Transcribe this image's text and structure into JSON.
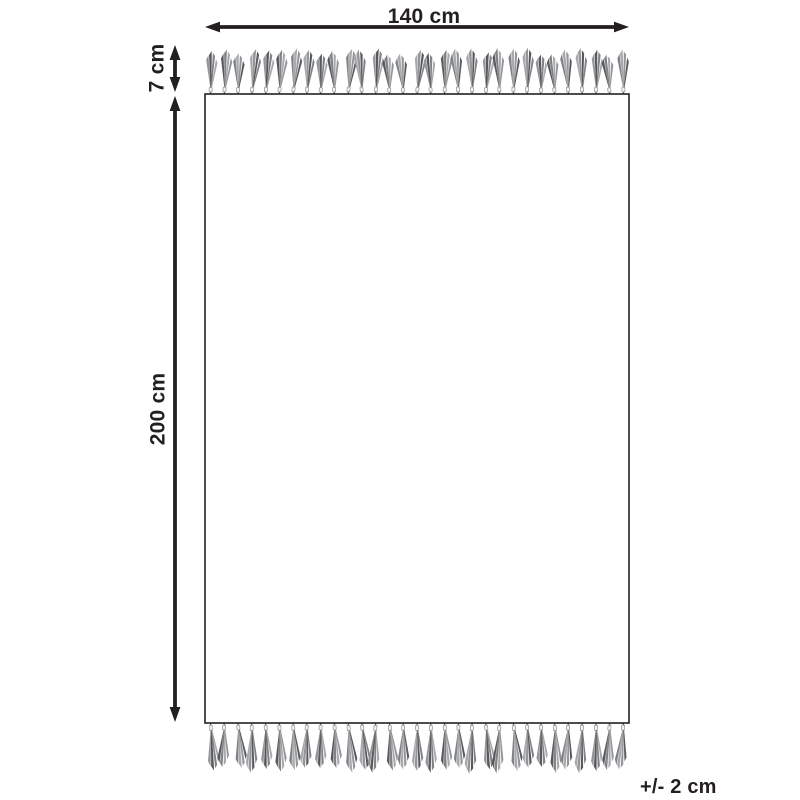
{
  "diagram": {
    "title": "Rug with fringe dimensions diagram",
    "labels": {
      "width": "140 cm",
      "height": "200 cm",
      "fringe": "7 cm",
      "tolerance": "+/- 2 cm"
    },
    "tassels": {
      "top_count": 31,
      "bottom_count": 31
    },
    "colors": {
      "ink": "#231f20",
      "background": "#ffffff",
      "tassel_shades": [
        "#939598",
        "#58595b",
        "#808285",
        "#a7a9ac"
      ],
      "tassel_tie": "#f1f1f2"
    }
  }
}
